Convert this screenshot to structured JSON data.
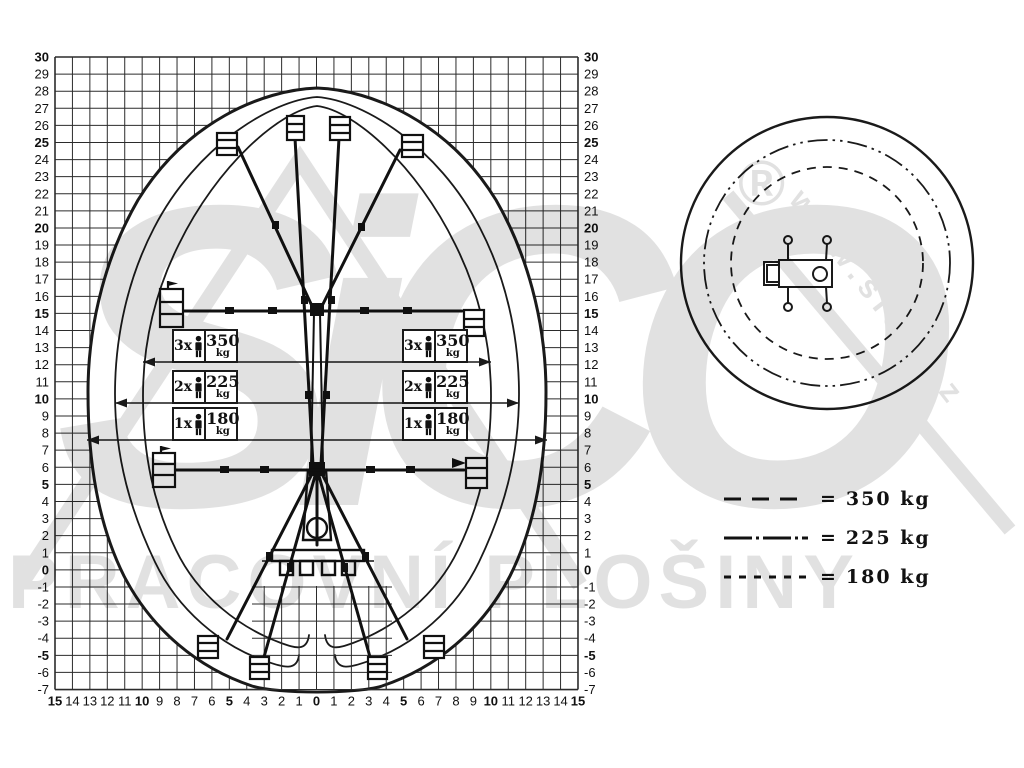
{
  "axes": {
    "y_ticks": [
      30,
      29,
      28,
      27,
      26,
      25,
      24,
      23,
      22,
      21,
      20,
      19,
      18,
      17,
      16,
      15,
      14,
      13,
      12,
      11,
      10,
      9,
      8,
      7,
      6,
      5,
      4,
      3,
      2,
      1,
      0,
      -1,
      -2,
      -3,
      -4,
      -5,
      -6,
      -7
    ],
    "x_ticks": [
      15,
      14,
      13,
      12,
      11,
      10,
      9,
      8,
      7,
      6,
      5,
      4,
      3,
      2,
      1,
      0,
      1,
      2,
      3,
      4,
      5,
      6,
      7,
      8,
      9,
      10,
      11,
      12,
      13,
      14,
      15
    ],
    "bold_interval": 5
  },
  "load_boxes": {
    "left": [
      {
        "count": "3x",
        "value": "350",
        "unit": "kg"
      },
      {
        "count": "2x",
        "value": "225",
        "unit": "kg"
      },
      {
        "count": "1x",
        "value": "180",
        "unit": "kg"
      }
    ],
    "right": [
      {
        "count": "3x",
        "value": "350",
        "unit": "kg"
      },
      {
        "count": "2x",
        "value": "225",
        "unit": "kg"
      },
      {
        "count": "1x",
        "value": "180",
        "unit": "kg"
      }
    ]
  },
  "legend": {
    "items": [
      {
        "style": "long-dash",
        "equals": "=",
        "label": "350 kg"
      },
      {
        "style": "dash-dot",
        "equals": "=",
        "label": "225 kg"
      },
      {
        "style": "short-dash",
        "equals": "=",
        "label": "180 kg"
      }
    ]
  },
  "watermark": {
    "brand": "SiCO",
    "registered": "®",
    "url": "www.sico.cz",
    "tagline": "PRACOVNÍ PLOŠINY"
  },
  "chart_data": {
    "type": "area",
    "title": "",
    "description": "Working envelope diagram of a spider aerial work platform with side-view reach grid and top-view slewing circles",
    "xlabel": "outreach (m)",
    "ylabel": "working height (m)",
    "xlim": [
      -15,
      15
    ],
    "ylim": [
      -7,
      30
    ],
    "grid": true,
    "max_height_m": 28,
    "min_depth_m": -7,
    "reach_lines": [
      {
        "persons": "3x",
        "load": "350 kg",
        "at_height_m": 12,
        "reach_m_each_side": 10
      },
      {
        "persons": "2x",
        "load": "225 kg",
        "at_height_m": 10,
        "reach_m_each_side": 11.7
      },
      {
        "persons": "1x",
        "load": "180 kg",
        "at_height_m": 8,
        "reach_m_each_side": 13.5
      }
    ],
    "top_view_circles": [
      {
        "style": "solid",
        "meaning": "outer working radius"
      },
      {
        "style": "dash-dot",
        "meaning": "225 kg radius"
      },
      {
        "style": "dashed",
        "meaning": "350 kg radius"
      }
    ]
  }
}
